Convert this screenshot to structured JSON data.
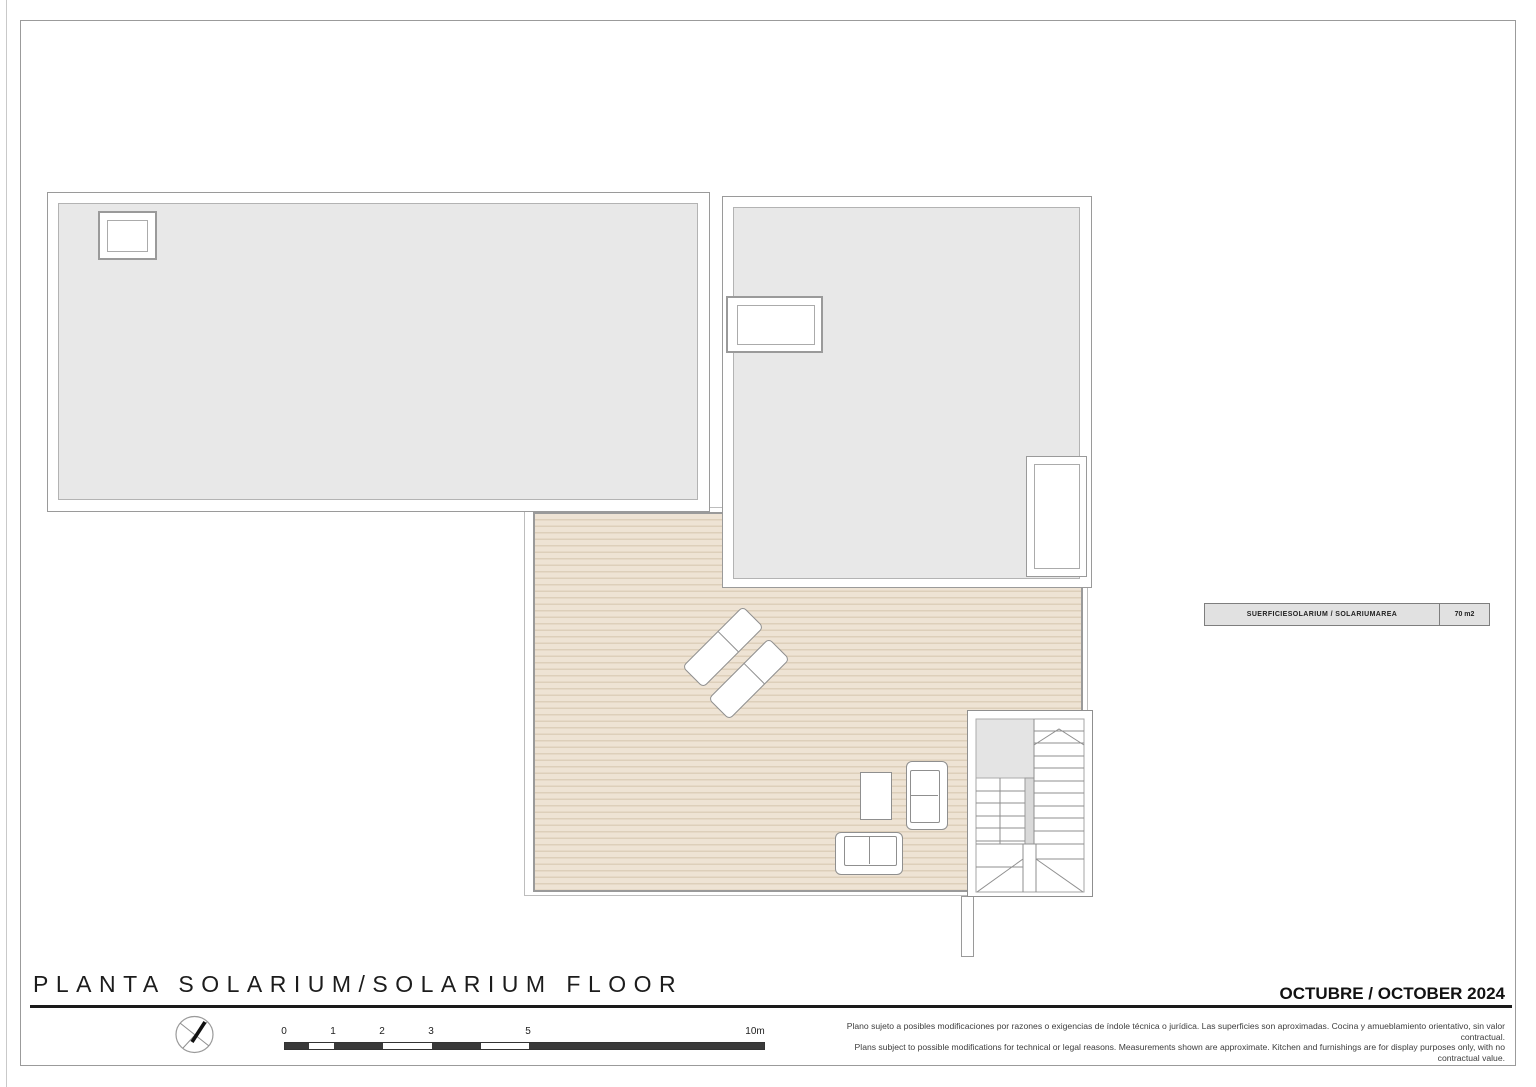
{
  "sheet": {
    "title": "PLANTA SOLARIUM/SOLARIUM FLOOR",
    "date": "OCTUBRE / OCTOBER 2024",
    "disclaimer_line1": "Plano sujeto a posibles modificaciones por razones o exigencias de índole técnica o jurídica. Las superficies son aproximadas. Cocina y amueblamiento orientativo, sin valor contractual.",
    "disclaimer_line2": "Plans subject to possible modifications for technical or legal reasons. Measurements shown are approximate. Kitchen and furnishings are for display purposes only, with no contractual value."
  },
  "area_table": {
    "label": "SUERFICIESOLARIUM / SOLARIUMAREA",
    "value": "70 m2"
  },
  "scale_bar": {
    "labels": [
      "0",
      "1",
      "2",
      "3",
      "5",
      "10m"
    ]
  },
  "icons": {
    "compass": "compass-rose-icon",
    "stair_arrow": "stair-direction-arrow"
  },
  "colors": {
    "deck_fill": "#eee3d4",
    "deck_stripe": "#ddcfba",
    "room_fill": "#e8e8e8",
    "wall_line": "#9a9a9a",
    "scale_dark": "#3a3a3a",
    "title_text": "#1c1c1c"
  }
}
